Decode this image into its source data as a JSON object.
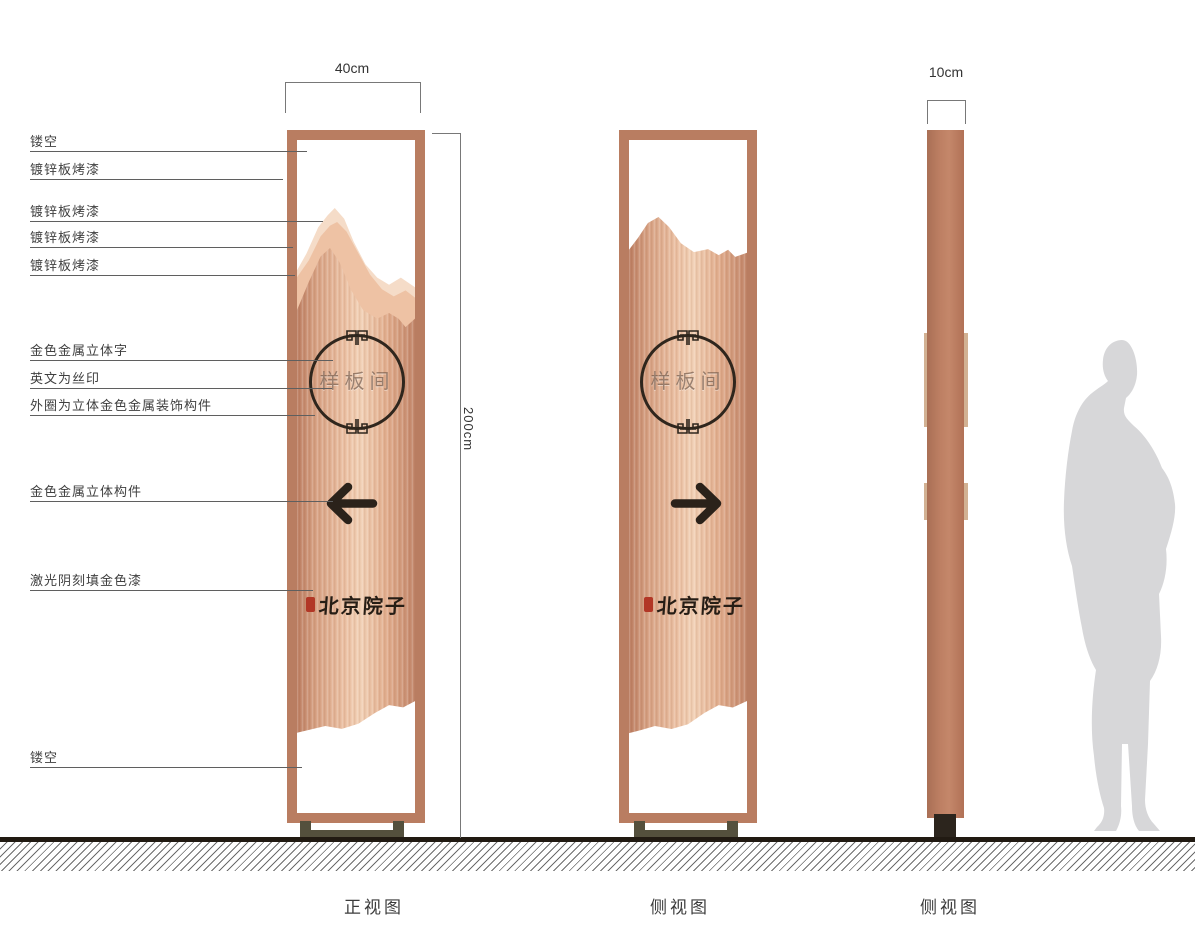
{
  "dimensions": {
    "width": "40cm",
    "height": "200cm",
    "depth": "10cm"
  },
  "callouts": [
    {
      "label": "镂空"
    },
    {
      "label": "镀锌板烤漆"
    },
    {
      "label": "镀锌板烤漆"
    },
    {
      "label": "镀锌板烤漆"
    },
    {
      "label": "镀锌板烤漆"
    },
    {
      "label": "金色金属立体字"
    },
    {
      "label": "英文为丝印"
    },
    {
      "label": "外圈为立体金色金属装饰构件"
    },
    {
      "label": "金色金属立体构件"
    },
    {
      "label": "激光阴刻填金色漆"
    },
    {
      "label": "镂空"
    }
  ],
  "sign": {
    "plaque_text": "样板间",
    "logo_text": "北京院子"
  },
  "view_labels": {
    "front": "正视图",
    "back": "侧视图",
    "side": "侧视图"
  },
  "icons": {
    "front_arrow": "left-arrow",
    "back_arrow": "right-arrow",
    "circle_ornament": "fret-ornament",
    "logo_seal": "red-seal",
    "scale_figure": "human-silhouette"
  },
  "colors": {
    "frame": "#b97d61",
    "panel_light": "#f2d1b6",
    "panel_dark": "#bd7f63",
    "mountain_light": "#f5dcc8",
    "mountain_mid": "#eec2a4",
    "accent_dark": "#2b221a",
    "seal_red": "#b23726",
    "base_olive": "#54503d",
    "silhouette_gray": "#d7d7d9"
  }
}
